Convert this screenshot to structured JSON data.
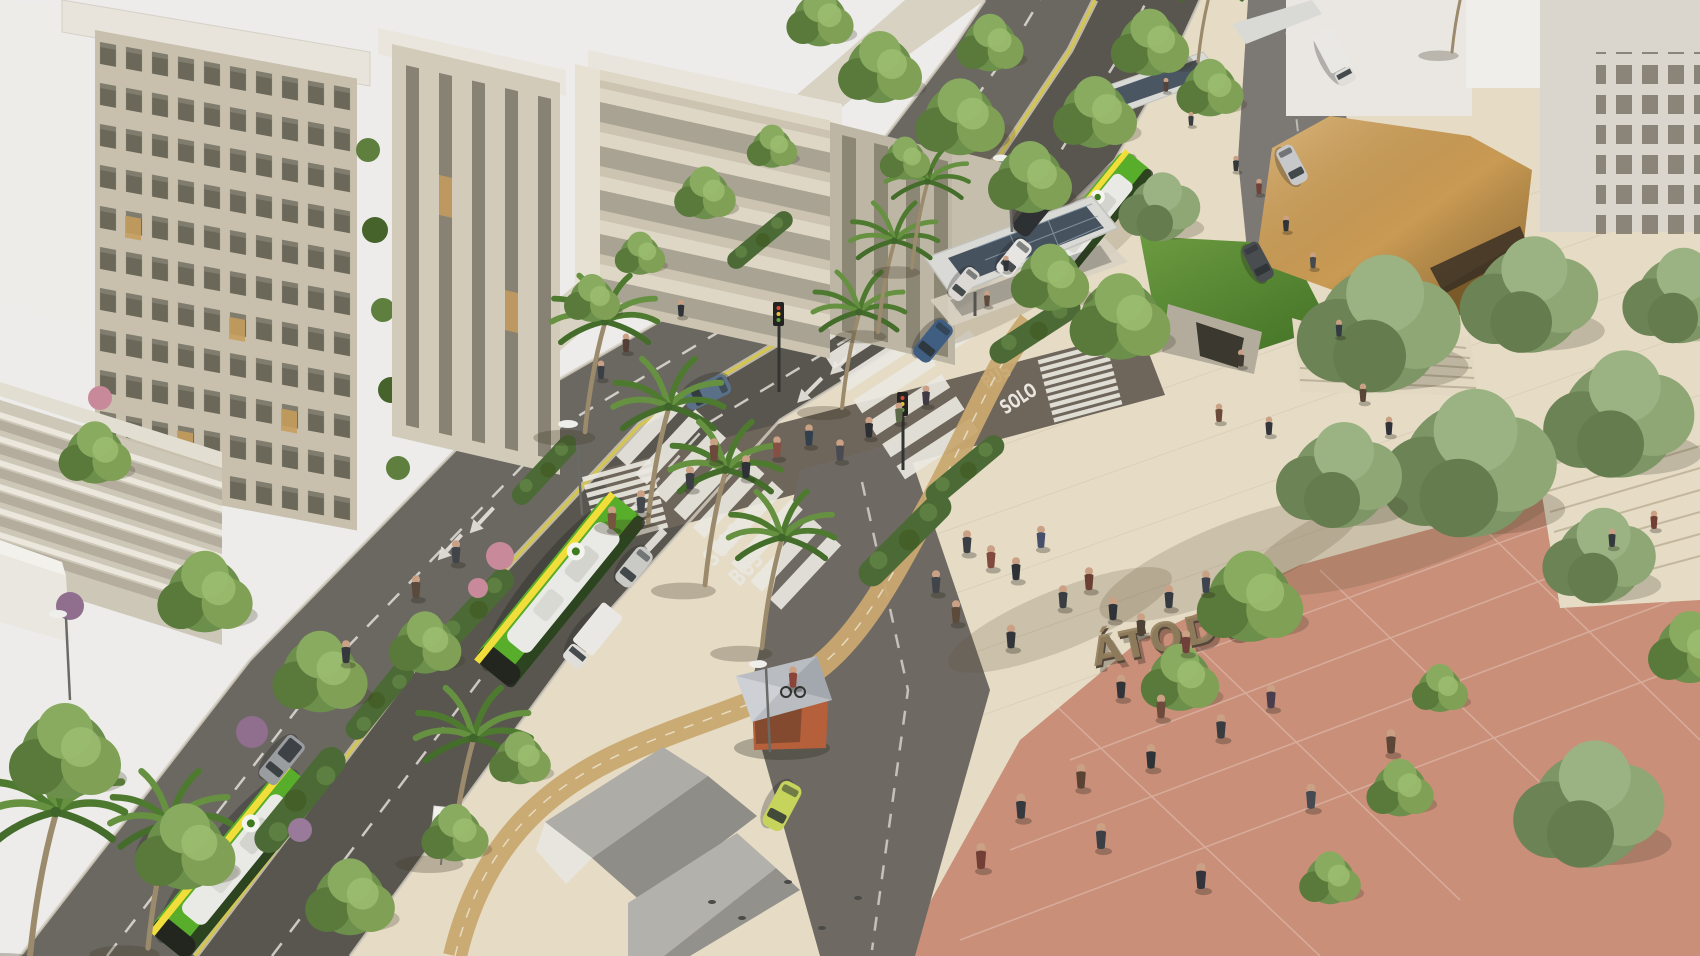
{
  "scene": {
    "type": "architectural-3d-render",
    "subject": "Aerial rendering of a redesigned urban avenue: dedicated green-bus lanes, palm-lined median, zebra crossings, pedestrian plaza with ÁTODOS sculpture sign, amber cultural pavilion, bus stop with solar canopy"
  },
  "signage": {
    "plaza_sign": "ÁTODOS",
    "marking_near_word1": "SOLO",
    "marking_near_word2": "BUS",
    "marking_far_word1": "BUS",
    "marking_far_word2": "SOLO"
  },
  "colors": {
    "sky": "#edecea",
    "plaza_beige": "#e6dcc6",
    "plaza_terracotta": "#c98f79",
    "asphalt": "#6b6862",
    "bus_asphalt": "#59564f",
    "bus_green": "#58ad2a",
    "bus_stripe_yellow": "#f2de3a",
    "taxi_yellow": "#c6d45c",
    "pavilion_amber": "#d3a257",
    "tree_green": "#6d8f4c",
    "bike_path_tan": "#c9a870"
  }
}
